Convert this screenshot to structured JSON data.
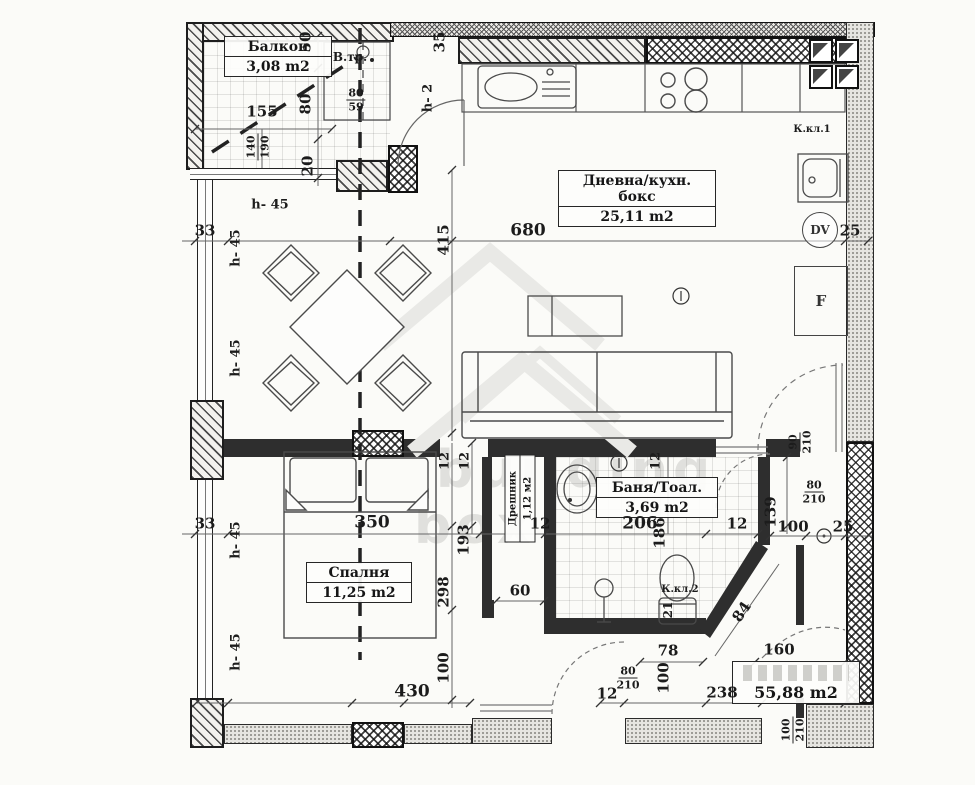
{
  "watermark": {
    "line1": "building",
    "line2": "box"
  },
  "rooms": {
    "balcony": {
      "name": "Балкон",
      "area": "3,08 m2"
    },
    "living": {
      "name": "Дневна/кухн. бокс",
      "area": "25,11 m2"
    },
    "bedroom": {
      "name": "Спалня",
      "area": "11,25 m2"
    },
    "closet": {
      "name": "Дрешник",
      "area": "1,12 м2"
    },
    "bath": {
      "name": "Баня/Тоал.",
      "area": "3,69 m2"
    },
    "total_area": "55,88 m2"
  },
  "annotations": {
    "vent_shaft": "В.тр.",
    "k_kl_1": "К.кл.1",
    "k_kl_2": "К.кл.2",
    "dv": "DV",
    "fridge": "F",
    "h2": "h- 2",
    "h45": "h- 45"
  },
  "dims": {
    "d155": "155",
    "d140": "140",
    "d190": "190",
    "d50": "50",
    "d80": "80",
    "d20": "20",
    "d35": "35",
    "d59": "59",
    "d33": "33",
    "d680": "680",
    "d25": "25",
    "d415": "415",
    "d350": "350",
    "d298": "298",
    "d193": "193",
    "d12": "12",
    "d206": "206",
    "d186": "186",
    "d60": "60",
    "d100": "100",
    "d430": "430",
    "d78": "78",
    "d238": "238",
    "d160": "160",
    "d84": "84",
    "d21": "21",
    "d210": "210",
    "d139": "139",
    "d90": "90"
  }
}
